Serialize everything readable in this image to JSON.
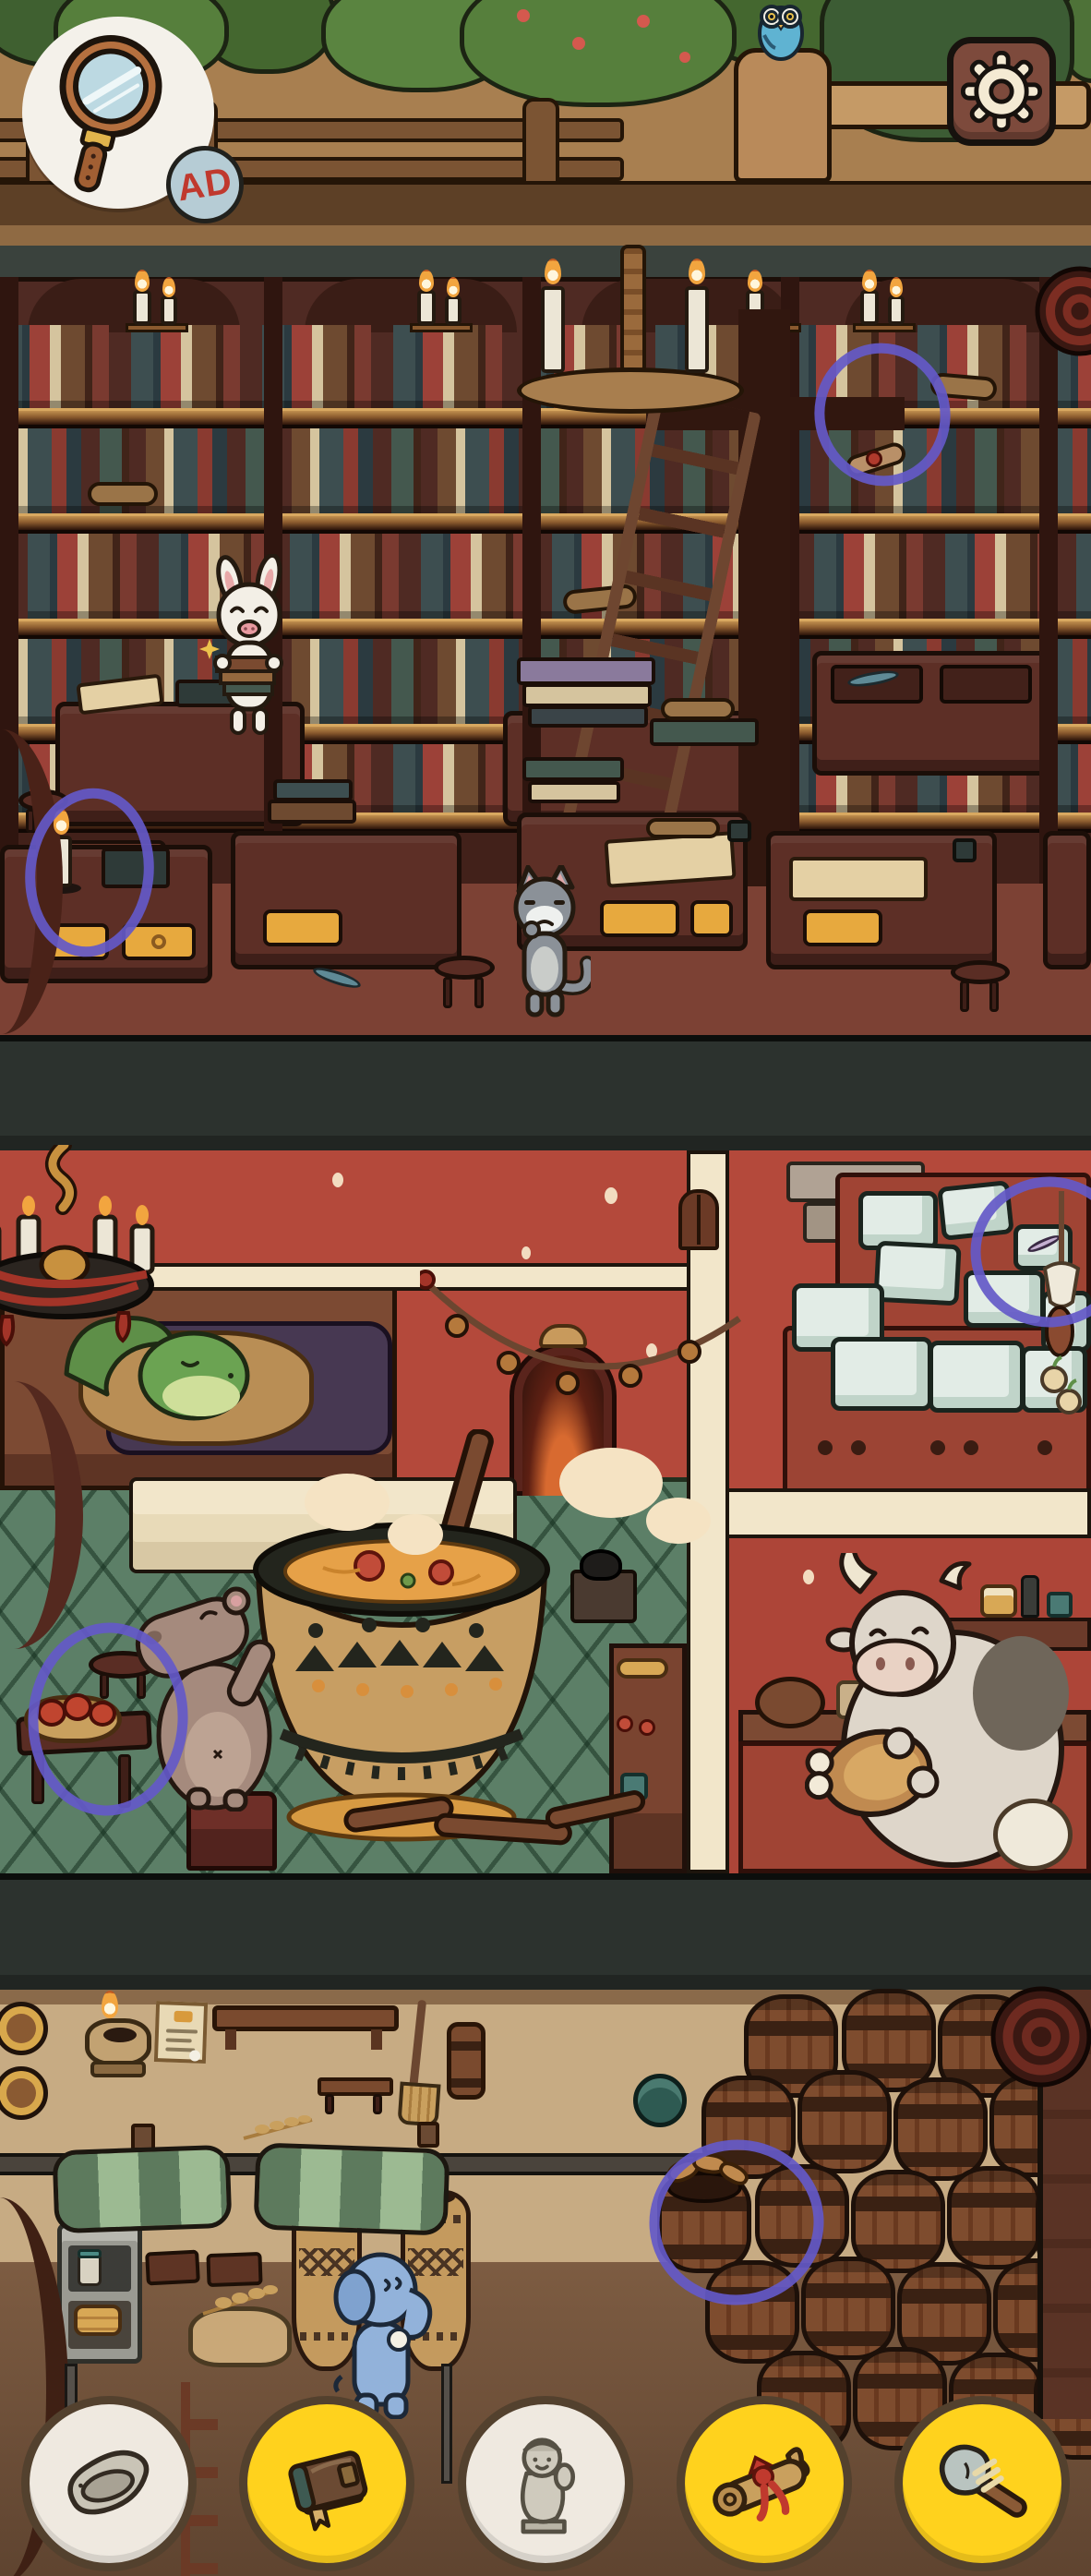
{
  "hud": {
    "hint_button": {
      "icon": "magnifying-glass-icon",
      "badge": "AD"
    },
    "settings_button": {
      "icon": "gear-icon"
    }
  },
  "item_tray": {
    "items": [
      {
        "icon": "stone-slab-icon",
        "style": "completed-white",
        "bg": "#efe9e0"
      },
      {
        "icon": "book-icon",
        "style": "active-yellow",
        "bg": "#ffd21d"
      },
      {
        "icon": "figurine-icon",
        "style": "completed-white",
        "bg": "#efe9e0"
      },
      {
        "icon": "scroll-icon",
        "style": "active-yellow",
        "bg": "#ffd21d"
      },
      {
        "icon": "stone-axe-icon",
        "style": "active-yellow",
        "bg": "#ffd21d"
      }
    ]
  },
  "found_marks": [
    {
      "shape": "hand-drawn-circle",
      "color": "#6459c8",
      "floor": "library",
      "target": "ribbon-scroll-on-shelf"
    },
    {
      "shape": "hand-drawn-circle",
      "color": "#6459c8",
      "floor": "library",
      "target": "lit-candle-on-desk"
    },
    {
      "shape": "hand-drawn-circle",
      "color": "#6459c8",
      "floor": "kitchen",
      "target": "item-frozen-in-ice-block"
    },
    {
      "shape": "hand-drawn-circle",
      "color": "#6459c8",
      "floor": "kitchen",
      "target": "apple-basket-table"
    },
    {
      "shape": "hand-drawn-circle",
      "color": "#6459c8",
      "floor": "cellar",
      "target": "barrel-with-bread"
    }
  ],
  "scene": {
    "floors": [
      {
        "name": "garden-strip",
        "elements": [
          "bushes",
          "berry-bush",
          "wooden-fence",
          "owl-on-stump",
          "blue-bird"
        ]
      },
      {
        "name": "library",
        "characters": [
          "white-pig-librarian",
          "grey-cat"
        ],
        "elements": [
          "bookshelves",
          "candle-chandelier",
          "wall-candles",
          "ladder",
          "writing-desks",
          "yellow-drawers",
          "stools",
          "lit-candle",
          "ink-pots",
          "scrolls",
          "parchment",
          "rolled-rug"
        ]
      },
      {
        "name": "kitchen",
        "characters": [
          "sleeping-turtle",
          "hippo-cook",
          "cow-with-ham"
        ],
        "elements": [
          "red-wall",
          "cream-beams",
          "candle-chandelier",
          "hay-loft-bed",
          "arched-door",
          "bell-garland",
          "hanging-window",
          "soup-cauldron",
          "wooden-paddle",
          "steam",
          "firewood",
          "green-tile-floor",
          "apple-basket-table",
          "ice-block-crates",
          "pantry-counter",
          "hanging-sausage-bundle"
        ]
      },
      {
        "name": "cellar",
        "characters": [
          "blue-elephant"
        ],
        "elements": [
          "oil-lamp",
          "pinned-note",
          "wall-shelf",
          "broom",
          "bench",
          "wheat-sprigs",
          "striped-stall-awnings",
          "stone-shelf-with-jars",
          "pancake-stack",
          "woven-amphorae",
          "bread-sack",
          "barrel-stacks",
          "bread-barrel",
          "teal-pot",
          "rolled-rug"
        ]
      }
    ]
  },
  "palette": {
    "accent_purple": "#6459c8",
    "hint_yellow": "#ffd21d",
    "found_white": "#efe9e0",
    "kitchen_wall_red": "#b4493b",
    "tile_green": "#5c7f67",
    "library_wood": "#4f2a23",
    "cellar_wall_tan": "#c7ab83",
    "outline_dark": "#1f140d"
  }
}
